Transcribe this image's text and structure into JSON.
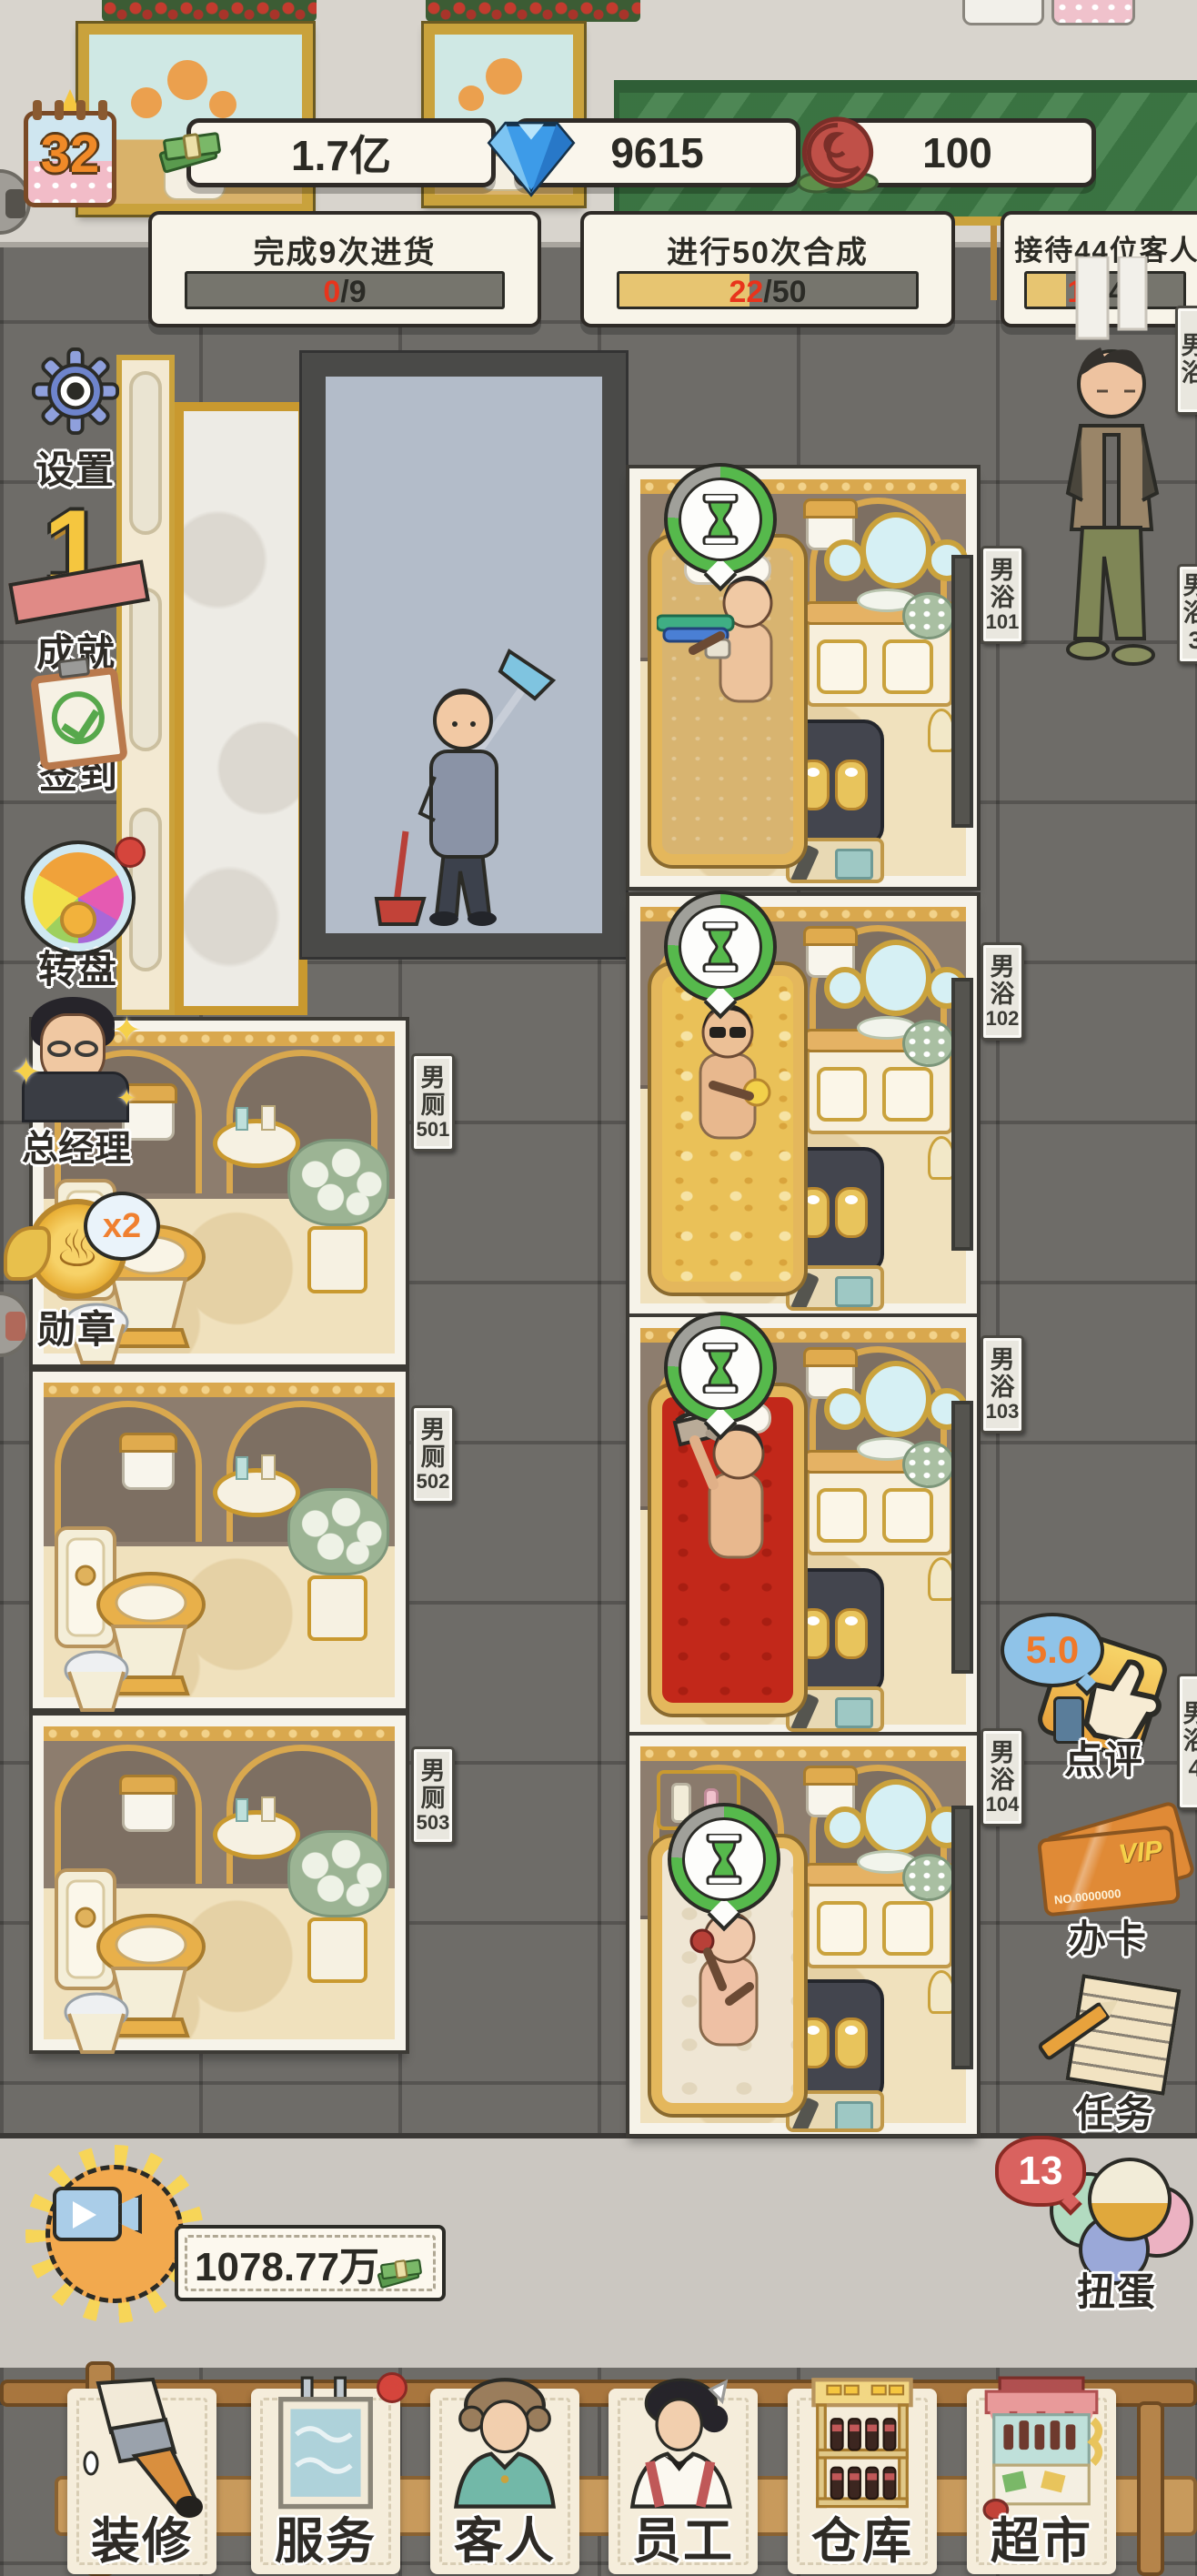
{
  "hud": {
    "level": "32",
    "money": "1.7亿",
    "diamonds": "9615",
    "roses": "100"
  },
  "quests": [
    {
      "title": "完成9次进货",
      "current": "0",
      "rest": "/9",
      "percent": 0
    },
    {
      "title": "进行50次合成",
      "current": "22",
      "rest": "/50",
      "percent": 44
    },
    {
      "title": "接待44位客人",
      "current": "11",
      "rest": "/44",
      "percent": 25
    }
  ],
  "left_menu": [
    {
      "label": "设置",
      "icon": "gear-icon"
    },
    {
      "label": "成就",
      "icon": "trophy-icon"
    },
    {
      "label": "签到",
      "icon": "checkin-clipboard-icon"
    },
    {
      "label": "转盘",
      "icon": "prize-wheel-icon"
    },
    {
      "label": "总经理",
      "icon": "manager-avatar"
    },
    {
      "label": "勋章",
      "icon": "medal-icon",
      "badge": "x2"
    }
  ],
  "right_menu": {
    "review": {
      "label": "点评",
      "rating": "5.0",
      "icon": "thumbs-up-badge-icon"
    },
    "vip": {
      "label": "办卡",
      "card_title": "VIP",
      "card_no": "NO.0000000",
      "icon": "vip-card-icon"
    },
    "tasks": {
      "label": "任务",
      "icon": "task-paper-icon"
    },
    "gacha": {
      "label": "扭蛋",
      "count": "13",
      "icon": "gacha-balls-icon"
    }
  },
  "rooms": {
    "baths": [
      {
        "hall": "男浴",
        "number": "101"
      },
      {
        "hall": "男浴",
        "number": "102"
      },
      {
        "hall": "男浴",
        "number": "103"
      },
      {
        "hall": "男浴",
        "number": "104"
      }
    ],
    "toilets": [
      {
        "hall": "男厕",
        "number": "501"
      },
      {
        "hall": "男厕",
        "number": "502"
      },
      {
        "hall": "男厕",
        "number": "503"
      }
    ],
    "edge_signs": [
      {
        "text": "男浴"
      },
      {
        "text": "男浴3"
      },
      {
        "text": "男浴4"
      }
    ]
  },
  "reward": {
    "amount": "1078.77万"
  },
  "bottom_nav": [
    {
      "label": "装修",
      "icon": "paintbrush-icon"
    },
    {
      "label": "服务",
      "icon": "service-water-icon",
      "notification": true
    },
    {
      "label": "客人",
      "icon": "guest-icon"
    },
    {
      "label": "员工",
      "icon": "staff-icon"
    },
    {
      "label": "仓库",
      "icon": "warehouse-icon"
    },
    {
      "label": "超市",
      "icon": "supermarket-icon"
    }
  ],
  "colors": {
    "bath_sand": "#d8b470",
    "bath_beer": "#eac158",
    "bath_red": "#c2281a",
    "bath_milk": "#efe6d4",
    "accent_red": "#e8341c",
    "progress_fill": "#e7c571",
    "timer_green": "#56b94c",
    "awning_green": "#3f7d47"
  }
}
